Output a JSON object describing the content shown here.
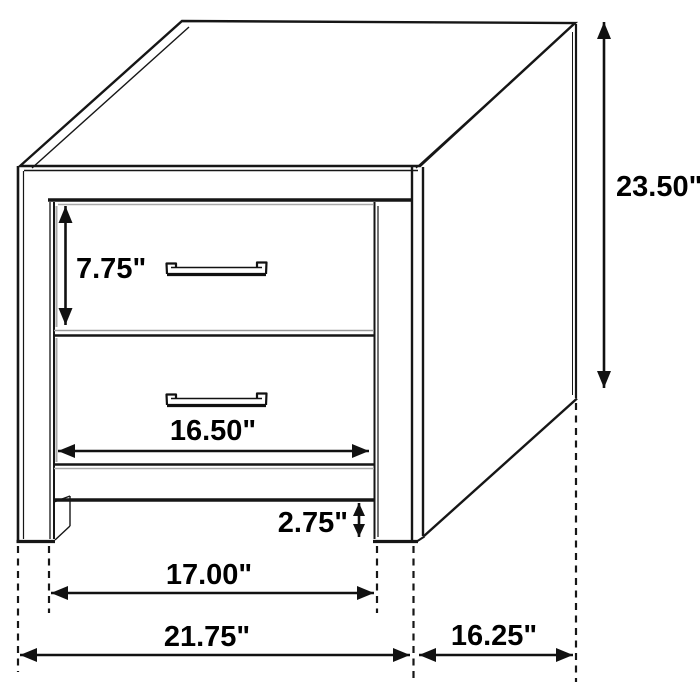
{
  "figure": {
    "type": "furniture-dimension-diagram",
    "subject": "two-drawer nightstand line drawing, oblique view",
    "units": "inches",
    "labels": {
      "overall_height": "23.50\"",
      "top_drawer_height": "7.75\"",
      "drawer_width": "16.50\"",
      "floor_clearance": "2.75\"",
      "inner_leg_width": "17.00\"",
      "overall_width": "21.75\"",
      "side_depth": "16.25\""
    },
    "colors": {
      "line": "#161616",
      "text": "#000000",
      "background": "#ffffff"
    }
  }
}
